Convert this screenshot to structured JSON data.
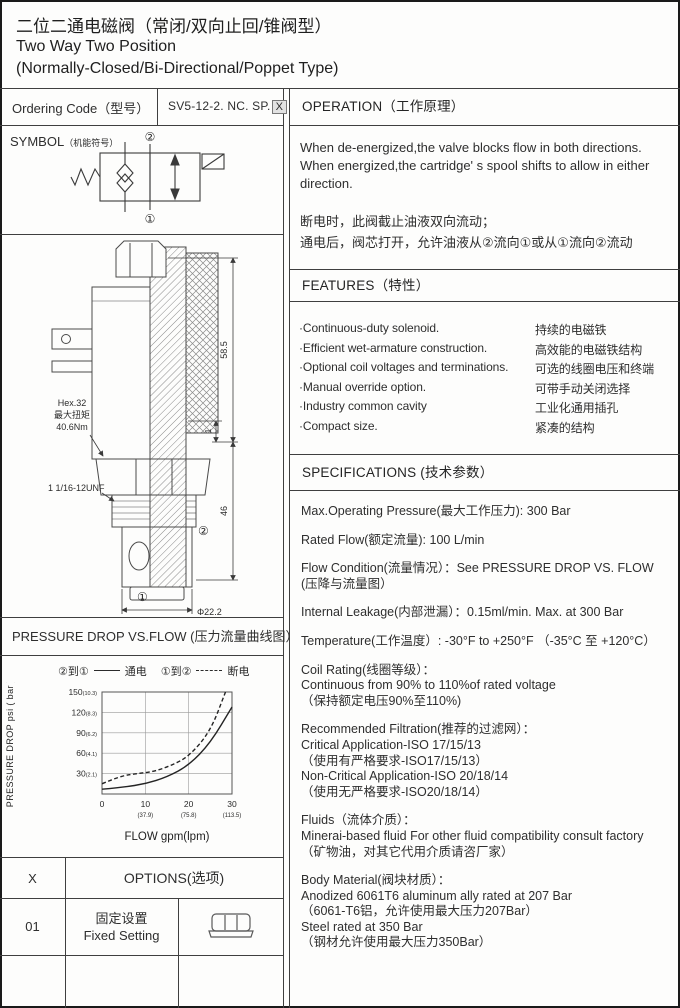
{
  "title": {
    "line1_cn": "二位二通电磁阀（常闭/双向止回/锥阀型）",
    "line2_en": "Two Way Two Position",
    "line3_en": "(Normally-Closed/Bi-Directional/Poppet Type)"
  },
  "ordering_code": {
    "label": "Ordering Code（型号）",
    "code": "SV5-12-2. NC. SP.",
    "code_variable": "X"
  },
  "symbol": {
    "header_main": "SYMBOL",
    "header_sub": "（机能符号）",
    "port_top_label": "②",
    "port_bottom_label": "①"
  },
  "drawing": {
    "hex_note_line1": "Hex.32",
    "hex_note_line2": "最大扭矩",
    "hex_note_line3": "40.6Nm",
    "thread_note": "1 1/16-12UNF",
    "dim_height_upper": "58.5",
    "dim_height_lower": "46",
    "dim_step": "1",
    "dim_diameter": "Φ22.2",
    "port_top_label": "②",
    "port_bottom_label": "①"
  },
  "operation": {
    "header": "OPERATION（工作原理）",
    "en_lines": [
      "When de-energized,the valve blocks flow in both directions.",
      "When energized,the cartridge' s spool shifts to allow in either",
      "direction."
    ],
    "cn_lines": [
      "断电时，此阀截止油液双向流动；",
      "通电后，阀芯打开，允许油液从②流向①或从①流向②流动"
    ]
  },
  "features": {
    "header": "FEATURES（特性）",
    "items": [
      {
        "en": "·Continuous-duty  solenoid.",
        "cn": "持续的电磁铁"
      },
      {
        "en": "·Efficient wet-armature construction.",
        "cn": "高效能的电磁铁结构"
      },
      {
        "en": "·Optional coil voltages and terminations.",
        "cn": "可选的线圈电压和终端"
      },
      {
        "en": "·Manual override option.",
        "cn": "可带手动关闭选择"
      },
      {
        "en": "·Industry common cavity",
        "cn": "工业化通用插孔"
      },
      {
        "en": "·Compact size.",
        "cn": "紧凑的结构"
      }
    ]
  },
  "specifications": {
    "header": "SPECIFICATIONS (技术参数）",
    "paragraphs": [
      [
        "Max.Operating Pressure(最大工作压力): 300 Bar"
      ],
      [
        "Rated Flow(额定流量): 100 L/min"
      ],
      [
        "Flow Condition(流量情况）：See PRESSURE DROP VS. FLOW",
        "(压降与流量图）"
      ],
      [
        "Internal Leakage(内部泄漏）：0.15ml/min. Max. at 300 Bar"
      ],
      [
        "Temperature(工作温度）: -30°F to +250°F （-35°C 至 +120°C）"
      ],
      [
        "Coil Rating(线圈等级）：",
        "Continuous from 90% to 110%of rated voltage",
        "（保持额定电压90%至110%)"
      ],
      [
        "Recommended Filtration(推荐的过滤网）：",
        "Critical Application-ISO 17/15/13",
        "（使用有严格要求-ISO17/15/13）",
        "Non-Critical Application-ISO 20/18/14",
        "（使用无严格要求-ISO20/18/14）"
      ],
      [
        "Fluids（流体介质）：",
        "Minerai-based fluid For other  fluid compatibility consult  factory",
        "（矿物油，对其它代用介质请咨厂家）"
      ],
      [
        "Body Material(阀块材质）：",
        "Anodized 6061T6 aluminum ally rated at 207 Bar",
        "（6061-T6铝，允许使用最大压力207Bar）",
        "Steel rated at 350 Bar",
        "（钢材允许使用最大压力350Bar）"
      ]
    ]
  },
  "pressure_chart": {
    "header": "PRESSURE DROP VS.FLOW  (压力流量曲线图）",
    "legend": [
      {
        "ports": "②到①",
        "style": "solid",
        "state": "通电"
      },
      {
        "ports": "①到②",
        "style": "dashed",
        "state": "断电"
      }
    ]
  },
  "chart_data": {
    "type": "line",
    "title": "PRESSURE DROP VS.FLOW  (压力流量曲线图）",
    "xlabel": "FLOW gpm(lpm)",
    "ylabel": "PRESSURE DROP  psi ( bar )",
    "xlim": [
      0,
      30
    ],
    "ylim": [
      0,
      150
    ],
    "grid": true,
    "legend_position": "top",
    "x_ticks": [
      {
        "gpm": 0,
        "lpm": ""
      },
      {
        "gpm": 10,
        "lpm": "(37.9)"
      },
      {
        "gpm": 20,
        "lpm": "(75.8)"
      },
      {
        "gpm": 30,
        "lpm": "(113.5)"
      }
    ],
    "y_ticks": [
      {
        "psi": 30,
        "bar": "(2.1)"
      },
      {
        "psi": 60,
        "bar": "(4.1)"
      },
      {
        "psi": 90,
        "bar": "(6.2)"
      },
      {
        "psi": 120,
        "bar": "(8.3)"
      },
      {
        "psi": 150,
        "bar": "(10.3)"
      }
    ],
    "series": [
      {
        "name": "②到① 通电",
        "style": "solid",
        "points_gpm_psi": [
          [
            0,
            7
          ],
          [
            5,
            10
          ],
          [
            10,
            15
          ],
          [
            15,
            25
          ],
          [
            20,
            42
          ],
          [
            25,
            75
          ],
          [
            30,
            128
          ]
        ]
      },
      {
        "name": "①到② 断电",
        "style": "dashed",
        "points_gpm_psi": [
          [
            0,
            15
          ],
          [
            4,
            26
          ],
          [
            8,
            30
          ],
          [
            12,
            33
          ],
          [
            16,
            42
          ],
          [
            20,
            55
          ],
          [
            25,
            92
          ],
          [
            28.5,
            150
          ]
        ]
      }
    ]
  },
  "options_table": {
    "col1_header": "X",
    "header": "OPTIONS(选项)",
    "rows": [
      {
        "code": "01",
        "desc_cn": "固定设置",
        "desc_en": "Fixed Setting",
        "icon": "fixed-setting-nut-icon"
      }
    ]
  },
  "colors": {
    "border": "#3f3f3f",
    "text": "#2e2e2e",
    "code_box_bg": "#e2e2e2"
  }
}
